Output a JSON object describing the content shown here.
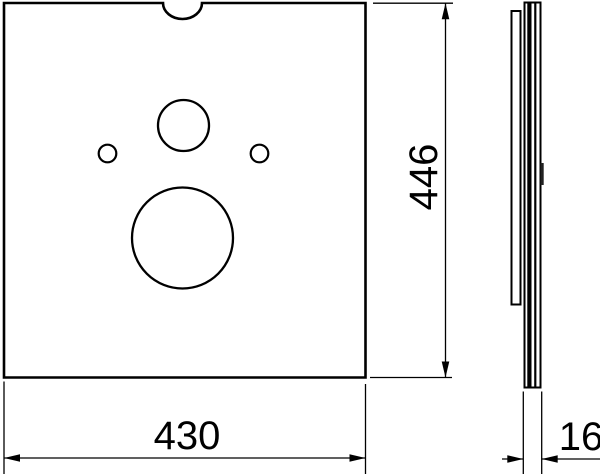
{
  "drawing": {
    "background_color": "#ffffff",
    "line_color": "#000000",
    "labels": {
      "width": "430",
      "height": "446",
      "thickness": "16"
    }
  }
}
